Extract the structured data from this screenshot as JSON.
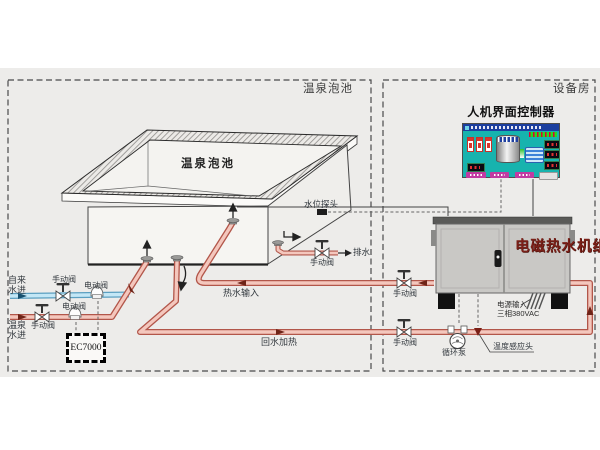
{
  "regions": {
    "pool_room_label": "温泉泡池",
    "equipment_room_label": "设备房"
  },
  "pool": {
    "name_label": "温泉泡池",
    "water_level_probe_label": "水位探头",
    "drain_flow_label": "排水",
    "drain_valve_label": "手动阀"
  },
  "inlets": {
    "tap_water_label": "自来水进",
    "tap_manual_valve_label": "手动阀",
    "tap_electric_valve_label": "电动阀",
    "spring_water_label": "温泉水进",
    "spring_manual_valve_label": "手动阀",
    "spring_electric_valve_label": "电动阀",
    "controller_label": "EC7000"
  },
  "loop": {
    "hot_supply_label": "热水输入",
    "hot_supply_valve_label": "手动阀",
    "return_label": "回水加热",
    "return_valve_label": "手动阀",
    "pump_label": "循环泵",
    "temp_sensor_label": "温度感应头"
  },
  "hmi": {
    "title": "人机界面控制器"
  },
  "machine": {
    "name": "电磁热水机组",
    "power_label_line1": "电源输入",
    "power_label_line2": "三相380VAC"
  },
  "colors": {
    "pipe_hot_edge": "#b2564a",
    "pipe_hot_fill": "#f4c7bd",
    "pipe_cold_edge": "#5b9fc0",
    "pipe_cold_fill": "#c3e7f6",
    "hmi_teal": "#17b3ae",
    "machine_gray": "#c9c8c5",
    "machine_label_red": "#7b2018"
  }
}
